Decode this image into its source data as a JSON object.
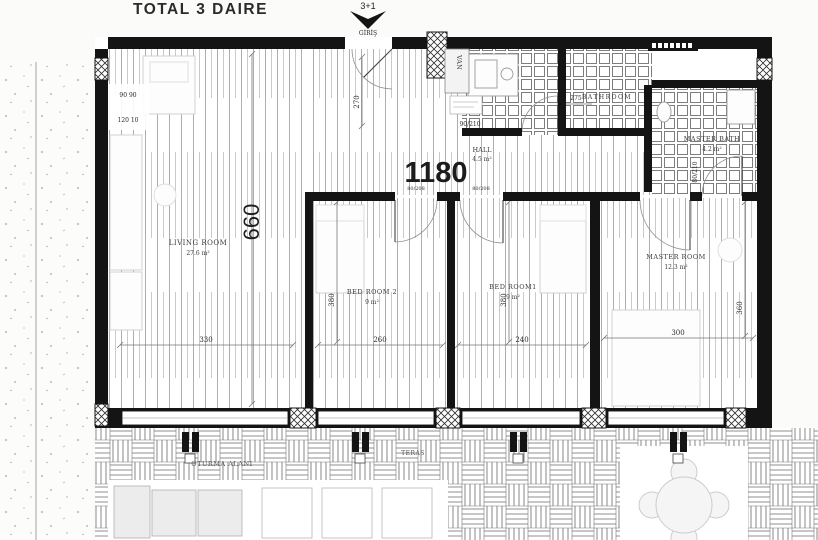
{
  "title": "TOTAL 3 DAIRE",
  "unit": {
    "type_label": "3+1",
    "entrance_label": "GİRİŞ",
    "total_width_dim": "1180",
    "total_depth_dim": "660"
  },
  "rooms": {
    "living": {
      "name": "LIVING ROOM",
      "area": "27.6 m²",
      "width_dim": "330"
    },
    "bed2": {
      "name": "BED ROOM 2",
      "area": "9 m²",
      "width_dim": "260",
      "depth_dim": "380",
      "door_dim": "80/208"
    },
    "bed1": {
      "name": "BED ROOM1",
      "area": "9 m²",
      "width_dim": "240",
      "depth_dim": "380",
      "door_dim": "80/208"
    },
    "master": {
      "name": "MASTER ROOM",
      "area": "12.3 m²",
      "width_dim": "300",
      "depth_dim": "360"
    },
    "master_bath": {
      "name": "MASTER BATH",
      "area": "4.2 m²",
      "door_dim": "80/210"
    },
    "hall": {
      "name": "HALL",
      "area": "4.5 m²",
      "depth_dim": "270"
    },
    "bathroom": {
      "name": "BATHROOM",
      "width_dim": "275",
      "door_dim": "90/210"
    }
  },
  "outdoor": {
    "terrace_label": "TERAS",
    "seating_label": "OTURMA ALANI"
  },
  "misc": {
    "shaft_label": "VAN",
    "wall_dim_a": "90 90",
    "wall_dim_b": "120 10"
  },
  "colors": {
    "wall": "#141414",
    "floor_line": "#9a9a9a",
    "background": "#fbfbfa",
    "furniture_line": "#c8c8c8"
  }
}
